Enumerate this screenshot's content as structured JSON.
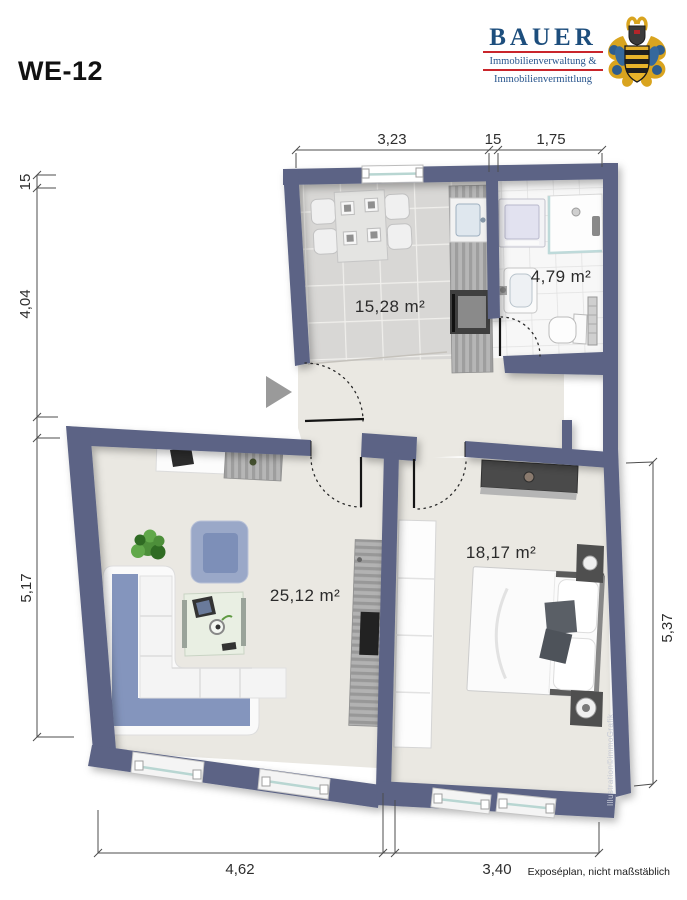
{
  "unit_label": "WE-12",
  "logo": {
    "name": "BAUER",
    "line1": "Immobilienverwaltung &",
    "line2": "Immobilienvermittlung",
    "brand_blue": "#1d4e7d",
    "brand_red": "#c9252b"
  },
  "rooms": {
    "kitchen": {
      "area": "15,28 m²"
    },
    "bathroom": {
      "area": "4,79 m²"
    },
    "living": {
      "area": "25,12 m²"
    },
    "bedroom": {
      "area": "18,17 m²"
    }
  },
  "dimensions": {
    "top": {
      "d1": "3,23",
      "d2": "15",
      "d3": "1,75"
    },
    "left": {
      "d1": "15",
      "d2": "4,04",
      "d3": "5,17"
    },
    "right": {
      "d1": "5,37"
    },
    "bottom": {
      "d1": "4,62",
      "d2": "3,40"
    }
  },
  "watermark": "Illustration©immoGrafik",
  "footer": {
    "note": "Exposéplan, nicht maßstäblich"
  },
  "colors": {
    "wall": "#5b6485",
    "floor": "#eae8e2",
    "kitchen_tile": "#d8d7d5",
    "bath_tile": "#f7f7f7",
    "sofa_blue": "#8495bd"
  }
}
